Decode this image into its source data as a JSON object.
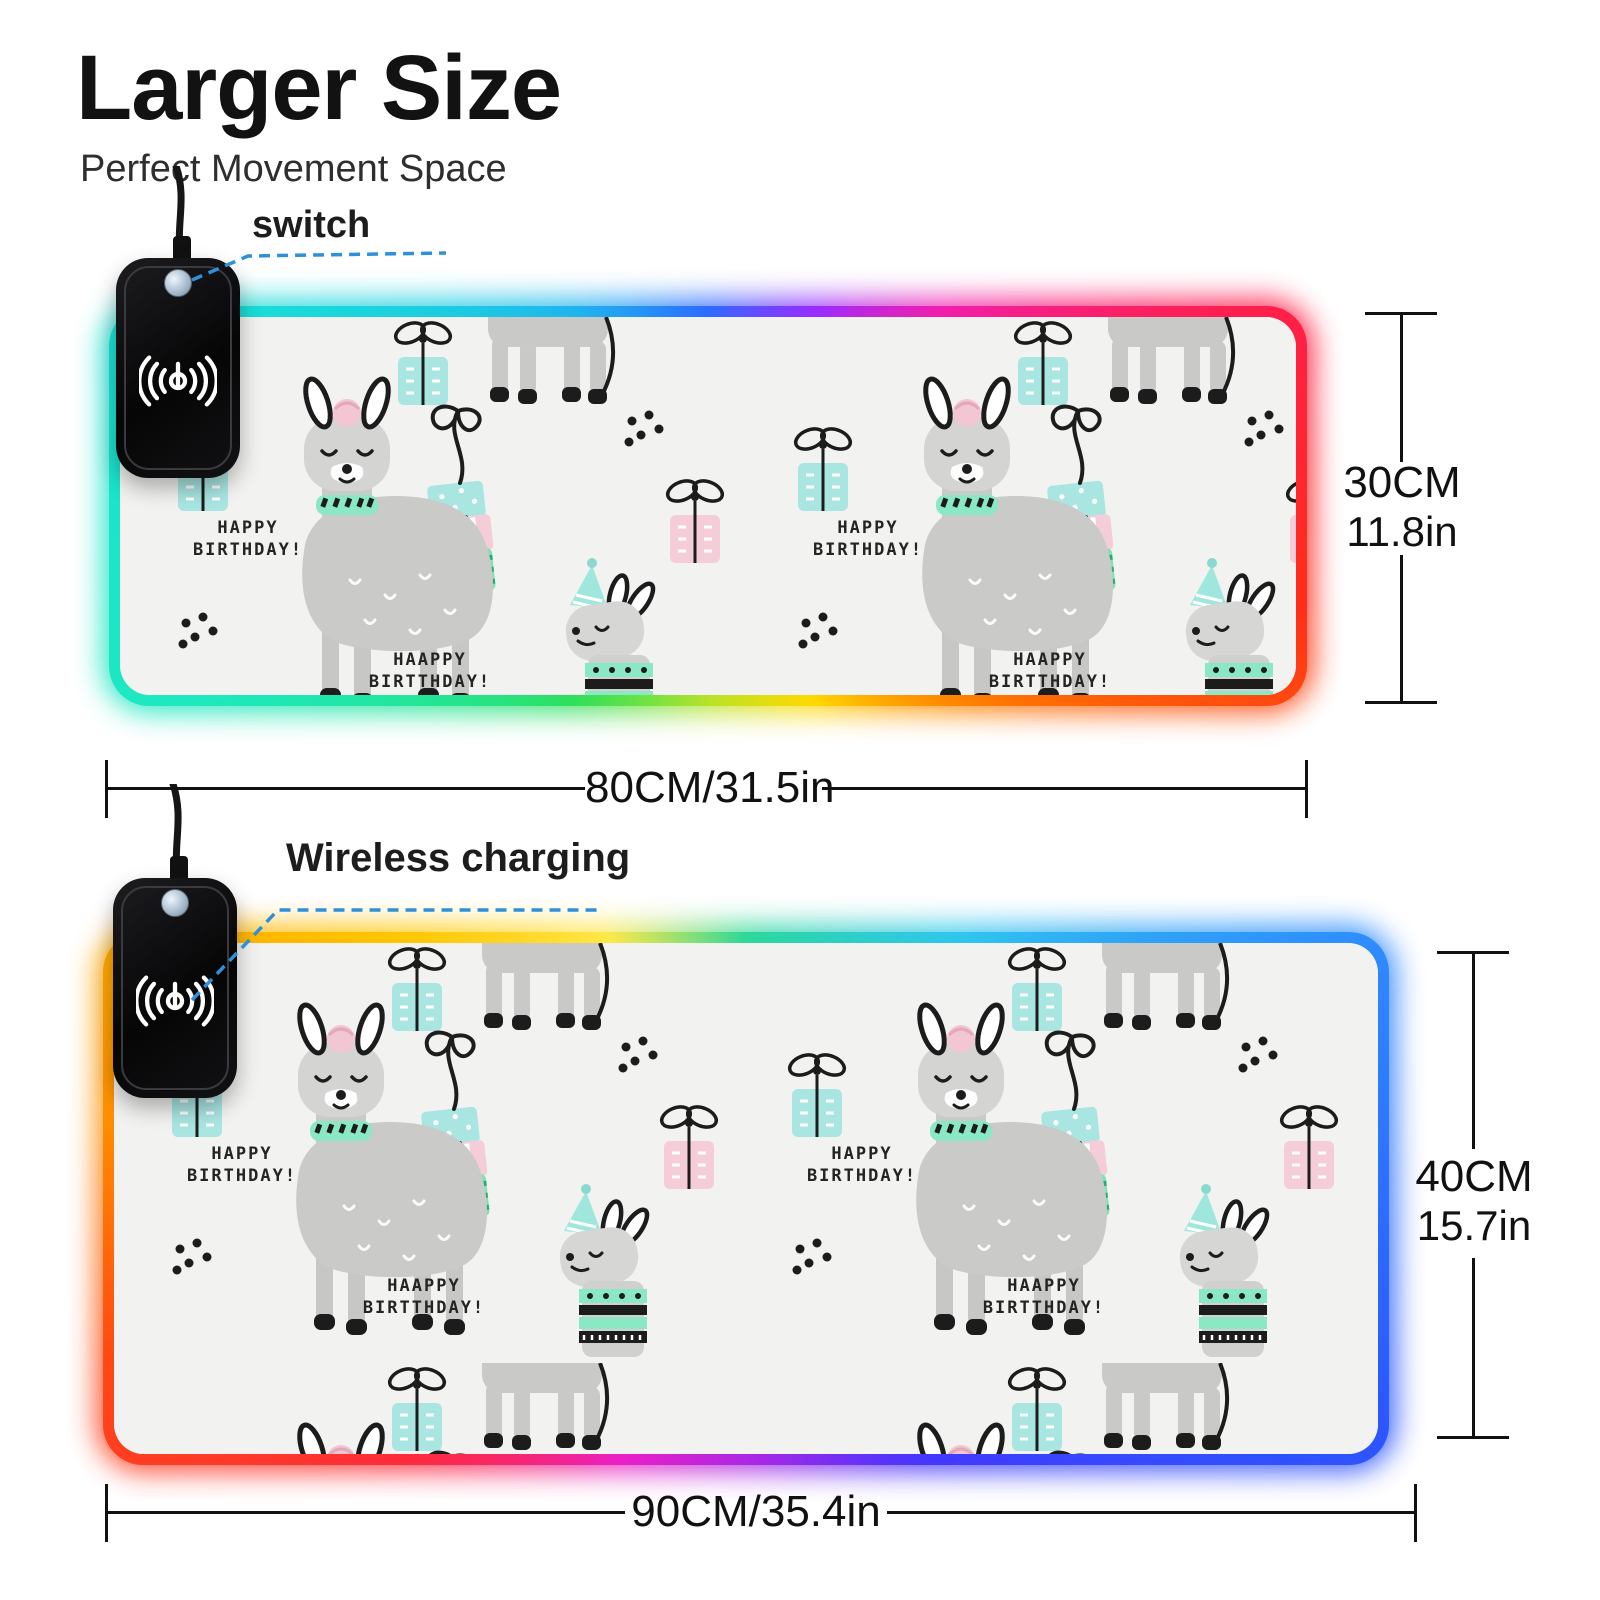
{
  "header": {
    "title": "Larger Size",
    "subtitle": "Perfect Movement Space"
  },
  "callouts": {
    "switch": "switch",
    "wireless": "Wireless charging"
  },
  "pads": [
    {
      "height_cm": "30CM",
      "height_in": "11.8in",
      "width_label": "80CM/31.5in"
    },
    {
      "height_cm": "40CM",
      "height_in": "15.7in",
      "width_label": "90CM/35.4in"
    }
  ],
  "pattern": {
    "texts": {
      "line1a": "HAPPY",
      "line1b": "BIRTHDAY!",
      "line2a": "HAAPPY",
      "line2b": "BIRTTHDAY!"
    }
  },
  "colors": {
    "callout_line": "#2e90d9",
    "dimension_line": "#111111",
    "pattern_background": "#f2f2f0",
    "llama_body": "#c9c9c8",
    "llama_accent_teal": "#8ae8c5",
    "llama_accent_pink": "#f2c6d2",
    "gift_teal": "#a9e6e2",
    "gift_pink": "#f5cdd8",
    "pad1_border": [
      [
        0,
        "#2e6bff"
      ],
      [
        30,
        "#9b2bff"
      ],
      [
        50,
        "#f01fb0"
      ],
      [
        71,
        "#ff1f49"
      ],
      [
        100,
        "#ff2e18"
      ],
      [
        125,
        "#ff7a00"
      ],
      [
        152,
        "#ffd900"
      ],
      [
        180,
        "#b6e32a"
      ],
      [
        215,
        "#2ee05c"
      ],
      [
        250,
        "#1de8c0"
      ],
      [
        290,
        "#19e0d6"
      ],
      [
        325,
        "#1fb5ee"
      ],
      [
        360,
        "#2e6bff"
      ]
    ],
    "pad2_border": [
      [
        0,
        "#2ed89a"
      ],
      [
        40,
        "#2fc6ee"
      ],
      [
        71,
        "#2f86ff"
      ],
      [
        108,
        "#2b58ff"
      ],
      [
        145,
        "#4436ff"
      ],
      [
        175,
        "#a129e8"
      ],
      [
        205,
        "#e820c8"
      ],
      [
        232,
        "#ff2a3c"
      ],
      [
        256,
        "#ff4912"
      ],
      [
        278,
        "#ff9100"
      ],
      [
        305,
        "#ffc400"
      ],
      [
        332,
        "#ffe84a"
      ],
      [
        360,
        "#2ed89a"
      ]
    ]
  }
}
